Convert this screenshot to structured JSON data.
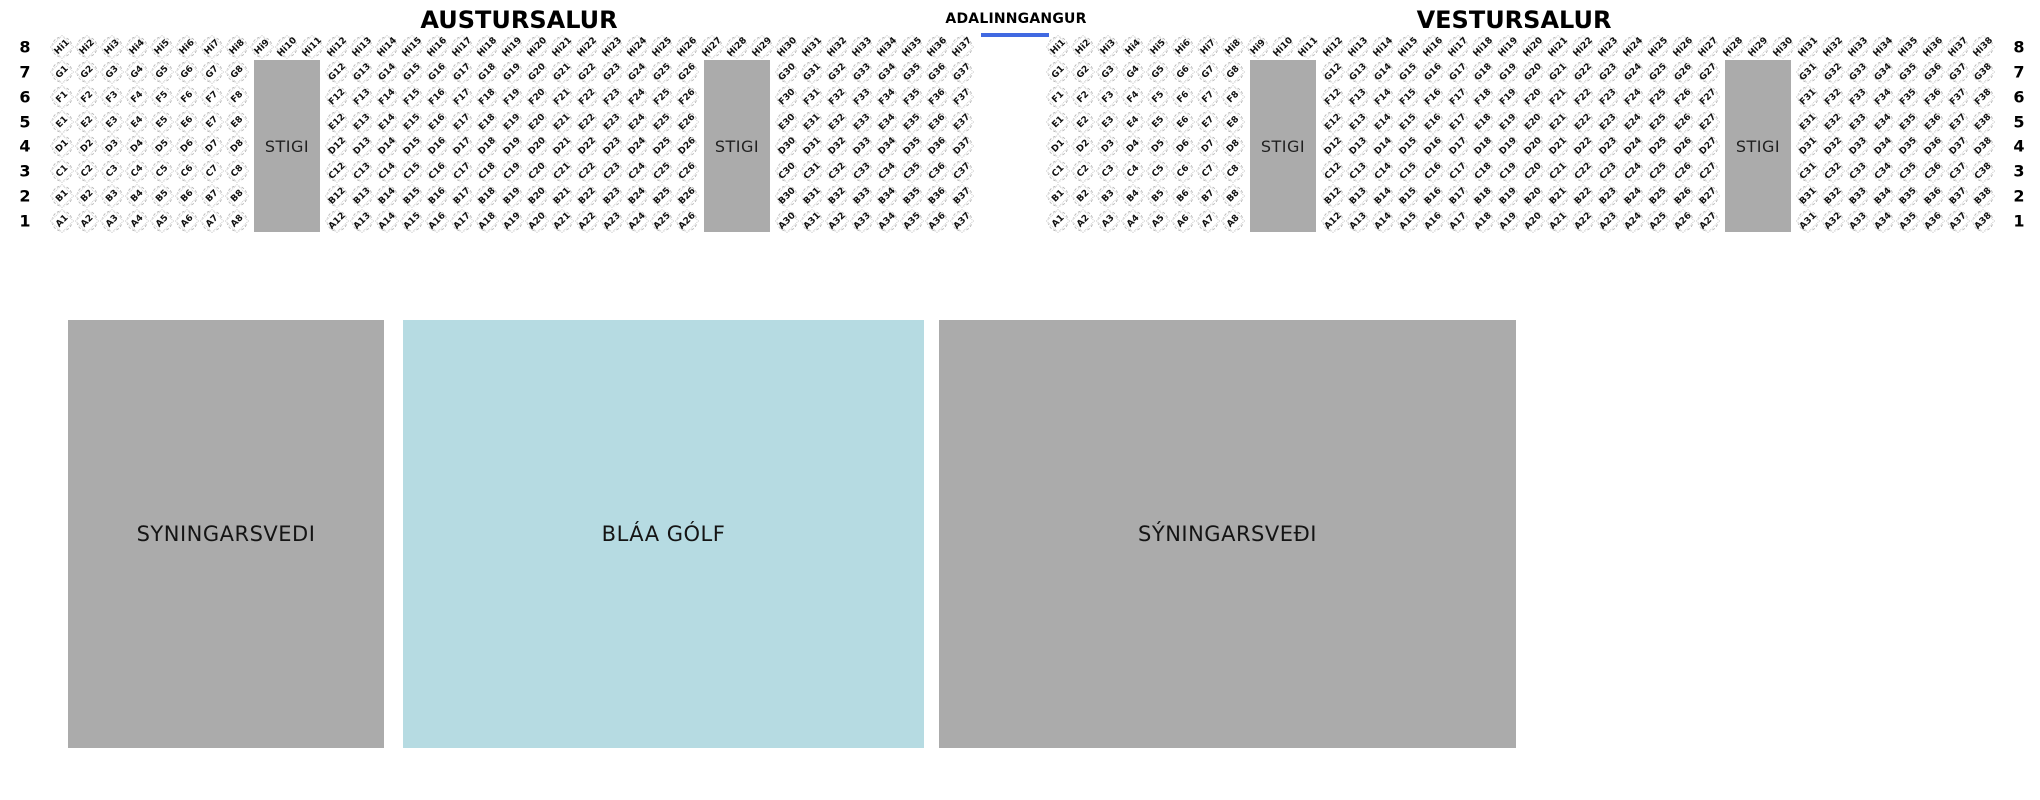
{
  "header": {
    "left_hall_title": "AUSTURSALUR",
    "entrance_label": "ADALINNGANGUR",
    "right_hall_title": "VESTURSALUR",
    "entrance_line_color": "#4169e1"
  },
  "row_numbers_left": [
    "8",
    "7",
    "6",
    "5",
    "4",
    "3",
    "2",
    "1"
  ],
  "row_numbers_right": [
    "8",
    "7",
    "6",
    "5",
    "4",
    "3",
    "2",
    "1"
  ],
  "stigi_label": "STIGI",
  "stigi_color": "#ababab",
  "seat_map": {
    "halls": [
      {
        "name": "AUSTURSALUR",
        "rows": [
          {
            "letter": "Hi",
            "blocks": [
              {
                "from": 1,
                "to": 11,
                "slot": 0
              },
              {
                "from": 12,
                "to": 29,
                "slot": 11
              },
              {
                "from": 30,
                "to": 37,
                "slot": 29
              }
            ]
          },
          {
            "letter": "G",
            "blocks": [
              {
                "from": 1,
                "to": 8,
                "slot": 0
              },
              {
                "from": 12,
                "to": 26,
                "slot": 11
              },
              {
                "from": 30,
                "to": 37,
                "slot": 29
              }
            ]
          },
          {
            "letter": "F",
            "blocks": [
              {
                "from": 1,
                "to": 8,
                "slot": 0
              },
              {
                "from": 12,
                "to": 26,
                "slot": 11
              },
              {
                "from": 30,
                "to": 37,
                "slot": 29
              }
            ]
          },
          {
            "letter": "E",
            "blocks": [
              {
                "from": 1,
                "to": 8,
                "slot": 0
              },
              {
                "from": 12,
                "to": 26,
                "slot": 11
              },
              {
                "from": 30,
                "to": 37,
                "slot": 29
              }
            ]
          },
          {
            "letter": "D",
            "blocks": [
              {
                "from": 1,
                "to": 8,
                "slot": 0
              },
              {
                "from": 12,
                "to": 26,
                "slot": 11
              },
              {
                "from": 30,
                "to": 37,
                "slot": 29
              }
            ]
          },
          {
            "letter": "C",
            "blocks": [
              {
                "from": 1,
                "to": 8,
                "slot": 0
              },
              {
                "from": 12,
                "to": 26,
                "slot": 11
              },
              {
                "from": 30,
                "to": 37,
                "slot": 29
              }
            ]
          },
          {
            "letter": "B",
            "blocks": [
              {
                "from": 1,
                "to": 8,
                "slot": 0
              },
              {
                "from": 12,
                "to": 26,
                "slot": 11
              },
              {
                "from": 30,
                "to": 37,
                "slot": 29
              }
            ]
          },
          {
            "letter": "A",
            "blocks": [
              {
                "from": 1,
                "to": 8,
                "slot": 0
              },
              {
                "from": 12,
                "to": 26,
                "slot": 11
              },
              {
                "from": 30,
                "to": 37,
                "slot": 29
              }
            ]
          }
        ],
        "stairs": [
          {
            "slot": 8
          },
          {
            "slot": 26
          }
        ]
      },
      {
        "name": "VESTURSALUR",
        "rows": [
          {
            "letter": "Hi",
            "blocks": [
              {
                "from": 1,
                "to": 11,
                "slot": 0
              },
              {
                "from": 12,
                "to": 30,
                "slot": 11
              },
              {
                "from": 31,
                "to": 38,
                "slot": 30
              }
            ]
          },
          {
            "letter": "G",
            "blocks": [
              {
                "from": 1,
                "to": 8,
                "slot": 0
              },
              {
                "from": 12,
                "to": 27,
                "slot": 11
              },
              {
                "from": 31,
                "to": 38,
                "slot": 30
              }
            ]
          },
          {
            "letter": "F",
            "blocks": [
              {
                "from": 1,
                "to": 8,
                "slot": 0
              },
              {
                "from": 12,
                "to": 27,
                "slot": 11
              },
              {
                "from": 31,
                "to": 38,
                "slot": 30
              }
            ]
          },
          {
            "letter": "E",
            "blocks": [
              {
                "from": 1,
                "to": 8,
                "slot": 0
              },
              {
                "from": 12,
                "to": 27,
                "slot": 11
              },
              {
                "from": 31,
                "to": 38,
                "slot": 30
              }
            ]
          },
          {
            "letter": "D",
            "blocks": [
              {
                "from": 1,
                "to": 8,
                "slot": 0
              },
              {
                "from": 12,
                "to": 27,
                "slot": 11
              },
              {
                "from": 31,
                "to": 38,
                "slot": 30
              }
            ]
          },
          {
            "letter": "C",
            "blocks": [
              {
                "from": 1,
                "to": 8,
                "slot": 0
              },
              {
                "from": 12,
                "to": 27,
                "slot": 11
              },
              {
                "from": 31,
                "to": 38,
                "slot": 30
              }
            ]
          },
          {
            "letter": "B",
            "blocks": [
              {
                "from": 1,
                "to": 8,
                "slot": 0
              },
              {
                "from": 12,
                "to": 27,
                "slot": 11
              },
              {
                "from": 31,
                "to": 38,
                "slot": 30
              }
            ]
          },
          {
            "letter": "A",
            "blocks": [
              {
                "from": 1,
                "to": 8,
                "slot": 0
              },
              {
                "from": 12,
                "to": 27,
                "slot": 11
              },
              {
                "from": 31,
                "to": 38,
                "slot": 30
              }
            ]
          }
        ],
        "stairs": [
          {
            "slot": 8
          },
          {
            "slot": 27
          }
        ]
      }
    ]
  },
  "floor_areas": [
    {
      "label": "SYNINGARSVEDI",
      "color": "#ababab"
    },
    {
      "label": "BLÁA GÓLF",
      "color": "#b6dbe2"
    },
    {
      "label": "SÝNINGARSVEÐI",
      "color": "#ababab"
    }
  ]
}
